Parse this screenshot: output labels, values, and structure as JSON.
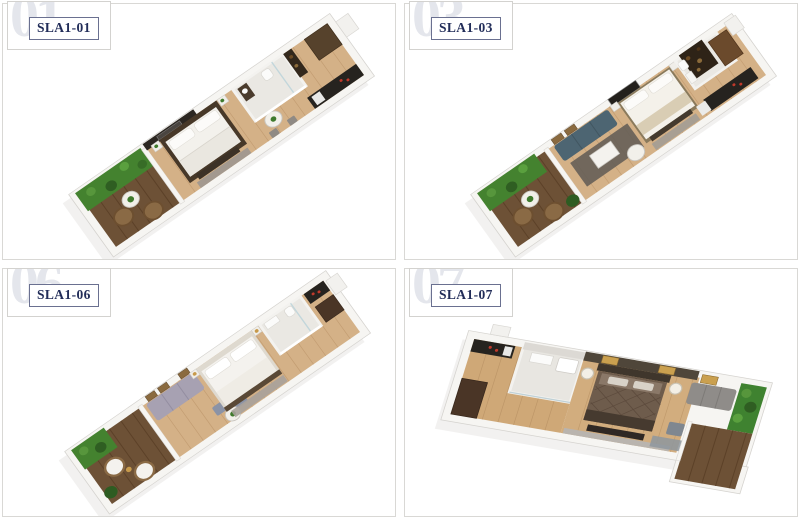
{
  "units": [
    {
      "watermark": "01",
      "label": "SLA1-01"
    },
    {
      "watermark": "03",
      "label": "SLA1-03"
    },
    {
      "watermark": "06",
      "label": "SLA1-06"
    },
    {
      "watermark": "07",
      "label": "SLA1-07"
    }
  ],
  "palette": {
    "label_text": "#222d59",
    "label_border": "#6a7090",
    "card_border": "#d3d2cf",
    "watermark_gray": "#e4e6ec",
    "panel_border": "#d9d8d5",
    "wall_white": "#f6f5f2",
    "wood_floor": "#d4b187",
    "deck_brown": "#6d5136",
    "garden_green": "#44822f",
    "bath_tile": "#eae8e3",
    "counter_black": "#26231f",
    "dark_wardrobe": "#4a3526",
    "bed_white": "#f4f2ee",
    "sofa_teal_unit03": "#4d6572",
    "sofa_lavender_unit06": "#a7a1b2",
    "sofa_gray_unit07": "#8f8c89",
    "bed_taupe_unit07": "#6e5c4c",
    "rug_gray": "#9d9790"
  }
}
